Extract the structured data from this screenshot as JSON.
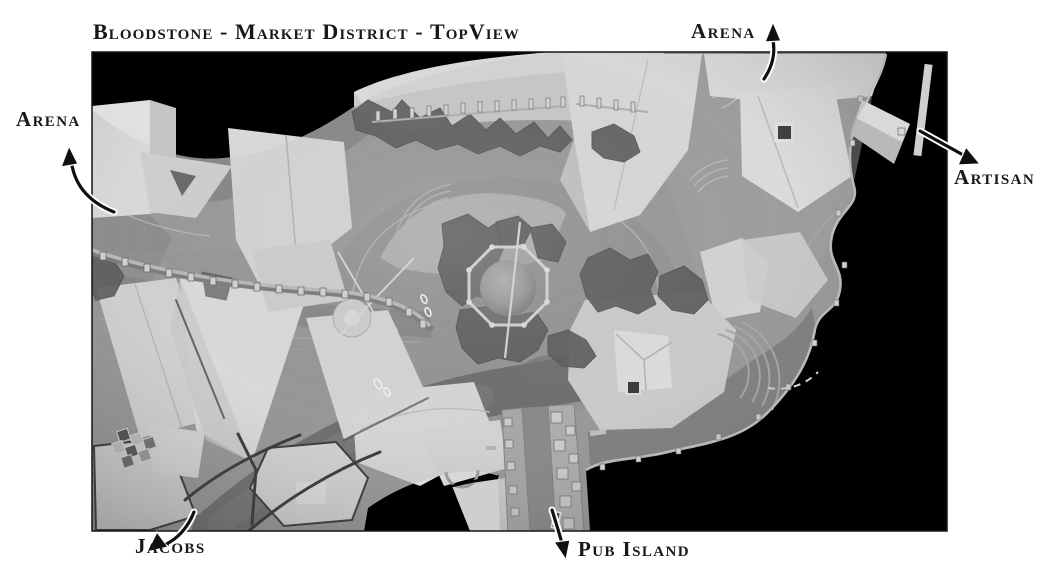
{
  "title": "Bloodstone - Market District - TopView",
  "labels": {
    "arena_top": "Arena",
    "arena_left": "Arena",
    "artisan": "Artisan",
    "jacobs": "Jacobs",
    "pub_island": "Pub Island"
  },
  "colors": {
    "page_background": "#ffffff",
    "map_background": "#000000",
    "label_ink": "#181818",
    "terrain_gray": "#8a8a8a",
    "rooftop_gray": "#dcdcdc",
    "rock_gray": "#3a3a3a"
  }
}
